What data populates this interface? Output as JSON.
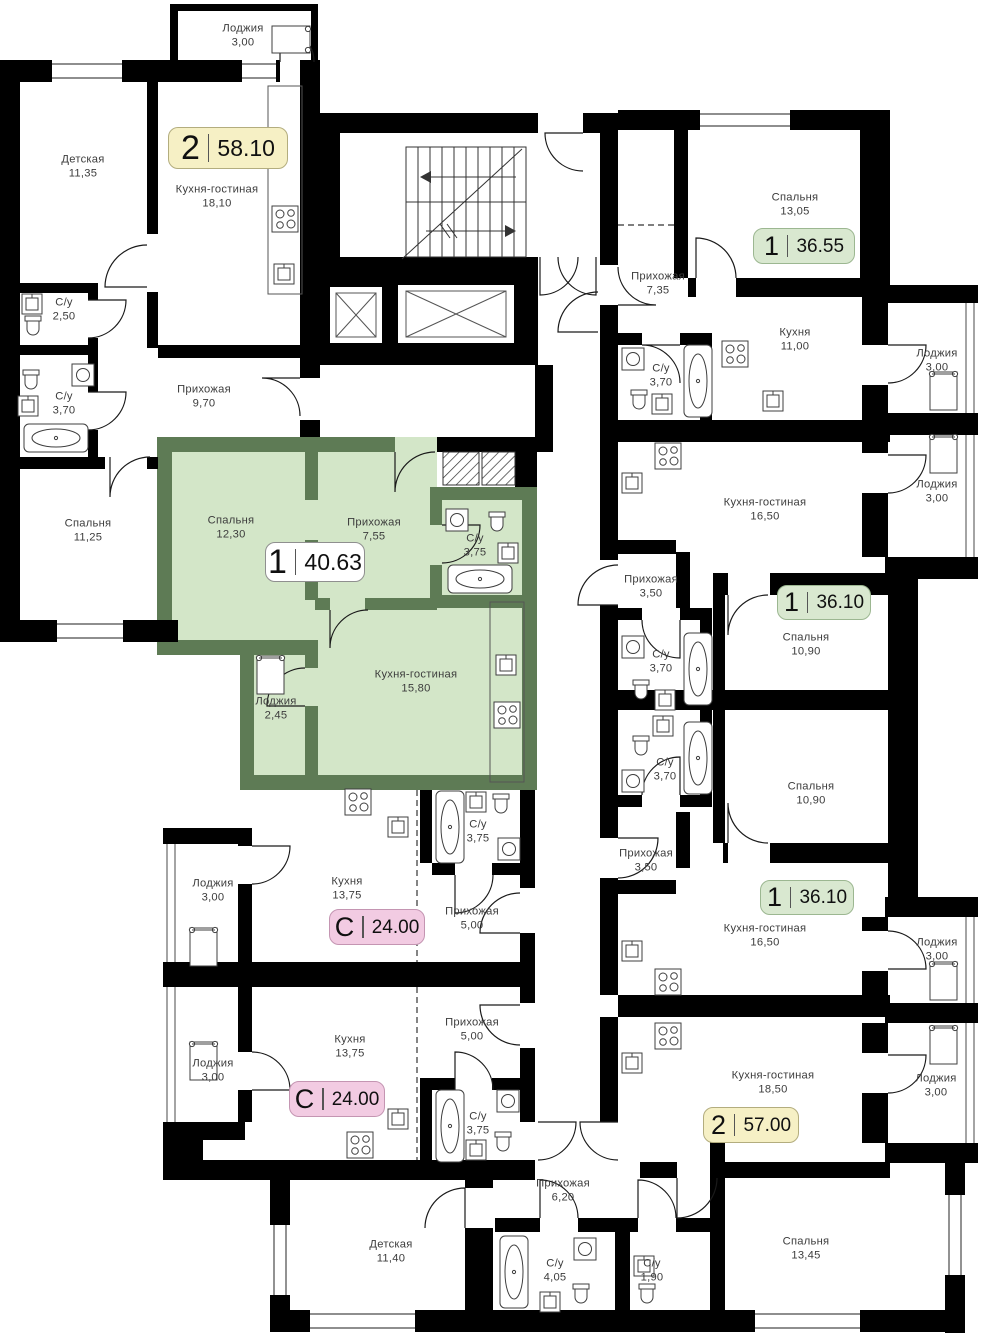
{
  "floor_plan": {
    "highlight_fill": "#d3e6c8",
    "highlight_wall": "#5e7b55",
    "wall_color": "#000000",
    "badges": [
      {
        "type": "2",
        "area": "58.10",
        "color": "#f6f0c5",
        "border": "#b3ad7e",
        "x": 168,
        "y": 127,
        "w": 120,
        "h": 42,
        "large": true
      },
      {
        "type": "1",
        "area": "40.63",
        "color": "#ffffff",
        "border": "#8f8f8f",
        "x": 265,
        "y": 542,
        "w": 100,
        "h": 40,
        "large": true
      },
      {
        "type": "1",
        "area": "36.55",
        "color": "#d9e8d0",
        "border": "#9cb791",
        "x": 753,
        "y": 228,
        "w": 102,
        "h": 36,
        "large": false
      },
      {
        "type": "1",
        "area": "36.10",
        "color": "#d9e8d0",
        "border": "#9cb791",
        "x": 777,
        "y": 585,
        "w": 94,
        "h": 35,
        "large": false
      },
      {
        "type": "1",
        "area": "36.10",
        "color": "#d9e8d0",
        "border": "#9cb791",
        "x": 760,
        "y": 880,
        "w": 94,
        "h": 35,
        "large": false
      },
      {
        "type": "2",
        "area": "57.00",
        "color": "#f6f0c5",
        "border": "#b3ad7e",
        "x": 703,
        "y": 1107,
        "w": 96,
        "h": 36,
        "large": false
      },
      {
        "type": "С",
        "area": "24.00",
        "color": "#f2cbe2",
        "border": "#c495b2",
        "x": 329,
        "y": 909,
        "w": 96,
        "h": 36,
        "large": false
      },
      {
        "type": "С",
        "area": "24.00",
        "color": "#f2cbe2",
        "border": "#c495b2",
        "x": 289,
        "y": 1081,
        "w": 96,
        "h": 36,
        "large": false
      }
    ],
    "rooms": [
      {
        "name": "Лоджия",
        "area": "3,00",
        "x": 243,
        "y": 36
      },
      {
        "name": "Детская",
        "area": "11,35",
        "x": 83,
        "y": 167
      },
      {
        "name": "Кухня-гостиная",
        "area": "18,10",
        "x": 217,
        "y": 197
      },
      {
        "name": "С/у",
        "area": "2,50",
        "x": 64,
        "y": 310
      },
      {
        "name": "С/у",
        "area": "3,70",
        "x": 64,
        "y": 404
      },
      {
        "name": "Прихожая",
        "area": "9,70",
        "x": 204,
        "y": 397
      },
      {
        "name": "Спальня",
        "area": "11,25",
        "x": 88,
        "y": 531
      },
      {
        "name": "Спальня",
        "area": "12,30",
        "x": 231,
        "y": 528
      },
      {
        "name": "Прихожая",
        "area": "7,55",
        "x": 374,
        "y": 530
      },
      {
        "name": "С/у",
        "area": "3,75",
        "x": 475,
        "y": 546
      },
      {
        "name": "Кухня-гостиная",
        "area": "15,80",
        "x": 416,
        "y": 682
      },
      {
        "name": "Лоджия",
        "area": "2,45",
        "x": 276,
        "y": 709
      },
      {
        "name": "Спальня",
        "area": "13,05",
        "x": 795,
        "y": 205
      },
      {
        "name": "Прихожая",
        "area": "7,35",
        "x": 658,
        "y": 284
      },
      {
        "name": "Кухня",
        "area": "11,00",
        "x": 795,
        "y": 340
      },
      {
        "name": "С/у",
        "area": "3,70",
        "x": 661,
        "y": 376
      },
      {
        "name": "Лоджия",
        "area": "3,00",
        "x": 937,
        "y": 361
      },
      {
        "name": "Кухня-гостиная",
        "area": "16,50",
        "x": 765,
        "y": 510
      },
      {
        "name": "Прихожая",
        "area": "3,50",
        "x": 651,
        "y": 587
      },
      {
        "name": "С/у",
        "area": "3,70",
        "x": 661,
        "y": 662
      },
      {
        "name": "Спальня",
        "area": "10,90",
        "x": 806,
        "y": 645
      },
      {
        "name": "Лоджия",
        "area": "3,00",
        "x": 937,
        "y": 492
      },
      {
        "name": "С/у",
        "area": "3,70",
        "x": 665,
        "y": 770
      },
      {
        "name": "Спальня",
        "area": "10,90",
        "x": 811,
        "y": 794
      },
      {
        "name": "Прихожая",
        "area": "3,50",
        "x": 646,
        "y": 861
      },
      {
        "name": "Кухня-гостиная",
        "area": "16,50",
        "x": 765,
        "y": 936
      },
      {
        "name": "Лоджия",
        "area": "3,00",
        "x": 937,
        "y": 950
      },
      {
        "name": "Кухня",
        "area": "13,75",
        "x": 347,
        "y": 889
      },
      {
        "name": "С/у",
        "area": "3,75",
        "x": 478,
        "y": 832
      },
      {
        "name": "Прихожая",
        "area": "5,00",
        "x": 472,
        "y": 919
      },
      {
        "name": "Лоджия",
        "area": "3,00",
        "x": 213,
        "y": 891
      },
      {
        "name": "Прихожая",
        "area": "5,00",
        "x": 472,
        "y": 1030
      },
      {
        "name": "Кухня",
        "area": "13,75",
        "x": 350,
        "y": 1047
      },
      {
        "name": "С/у",
        "area": "3,75",
        "x": 478,
        "y": 1124
      },
      {
        "name": "Лоджия",
        "area": "3,00",
        "x": 213,
        "y": 1071
      },
      {
        "name": "Кухня-гостиная",
        "area": "18,50",
        "x": 773,
        "y": 1083
      },
      {
        "name": "Лоджия",
        "area": "3,00",
        "x": 936,
        "y": 1086
      },
      {
        "name": "Прихожая",
        "area": "6,20",
        "x": 563,
        "y": 1191
      },
      {
        "name": "Детская",
        "area": "11,40",
        "x": 391,
        "y": 1252
      },
      {
        "name": "С/у",
        "area": "4,05",
        "x": 555,
        "y": 1271
      },
      {
        "name": "С/у",
        "area": "1,90",
        "x": 652,
        "y": 1271
      },
      {
        "name": "Спальня",
        "area": "13,45",
        "x": 806,
        "y": 1249
      }
    ]
  }
}
